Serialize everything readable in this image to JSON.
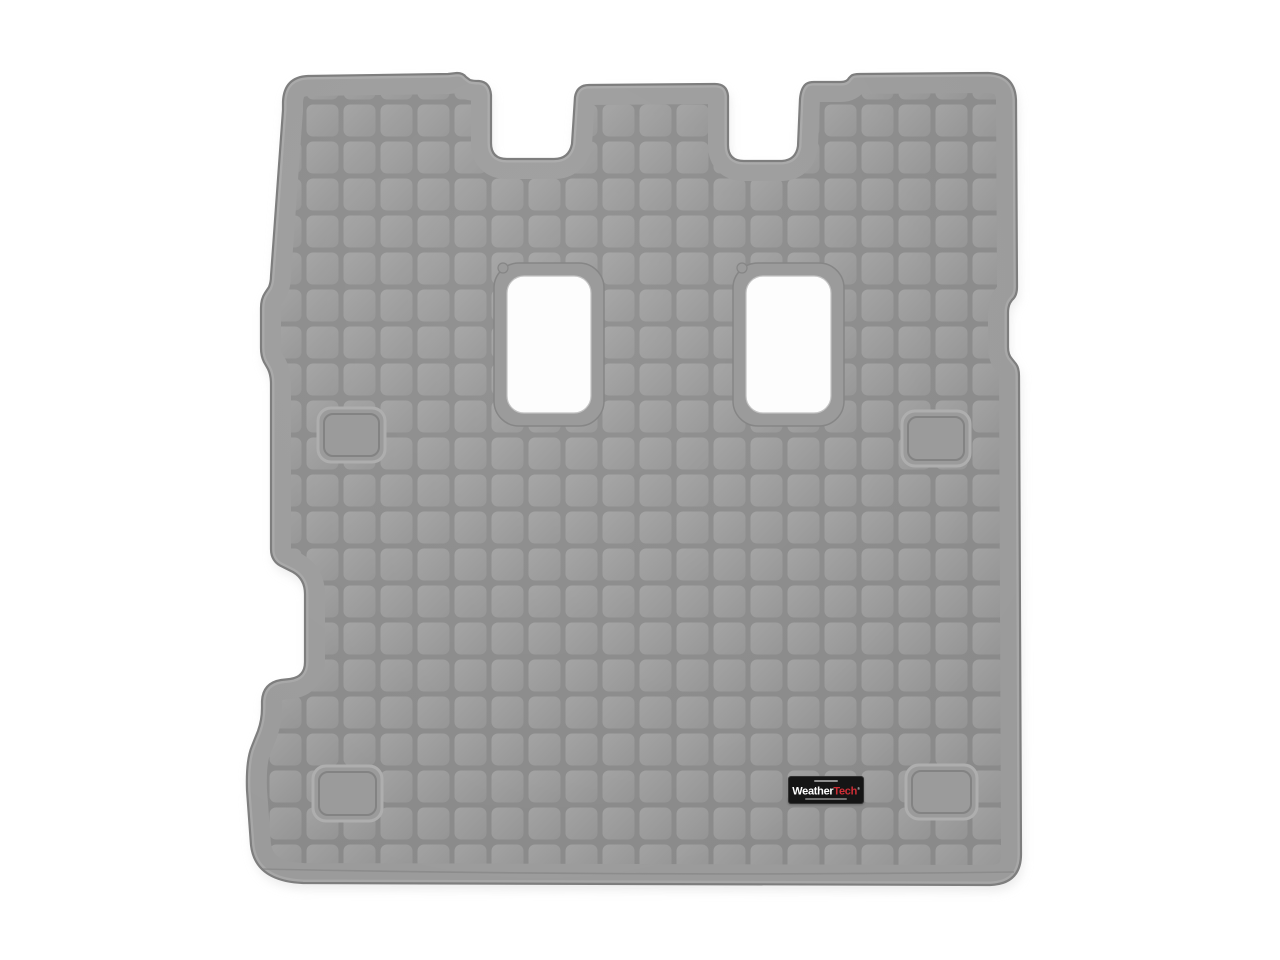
{
  "image": {
    "type": "product-photo",
    "subject": "WeatherTech gray rubber cargo liner floor mat with grid tread pattern, two rectangular seat-anchor cutouts and four recessed retention pads",
    "background_color": "#ffffff"
  },
  "colors": {
    "mat_base": "#9b9b9b",
    "groove": "#8a8a8a",
    "tile_light": "#a2a2a2",
    "tile_dark": "#949494",
    "edge_line": "#7e7e7e",
    "edge_highlight": "#a8a8a8",
    "cutout_fill": "#fdfdfd",
    "cutout_edge": "#c2c2c2",
    "ring_line": "#868686",
    "anchor_highlight": "#aeaeae",
    "anchor_shadow": "#7f7f7f",
    "crease": "#898989",
    "shadow": "#dcdcdc",
    "badge_background": "#151515",
    "badge_text_white": "#ffffff",
    "badge_text_red": "#cf2e36"
  },
  "badge": {
    "brand_part1": "Weather",
    "brand_part2": "Tech",
    "registered_mark": "®"
  }
}
